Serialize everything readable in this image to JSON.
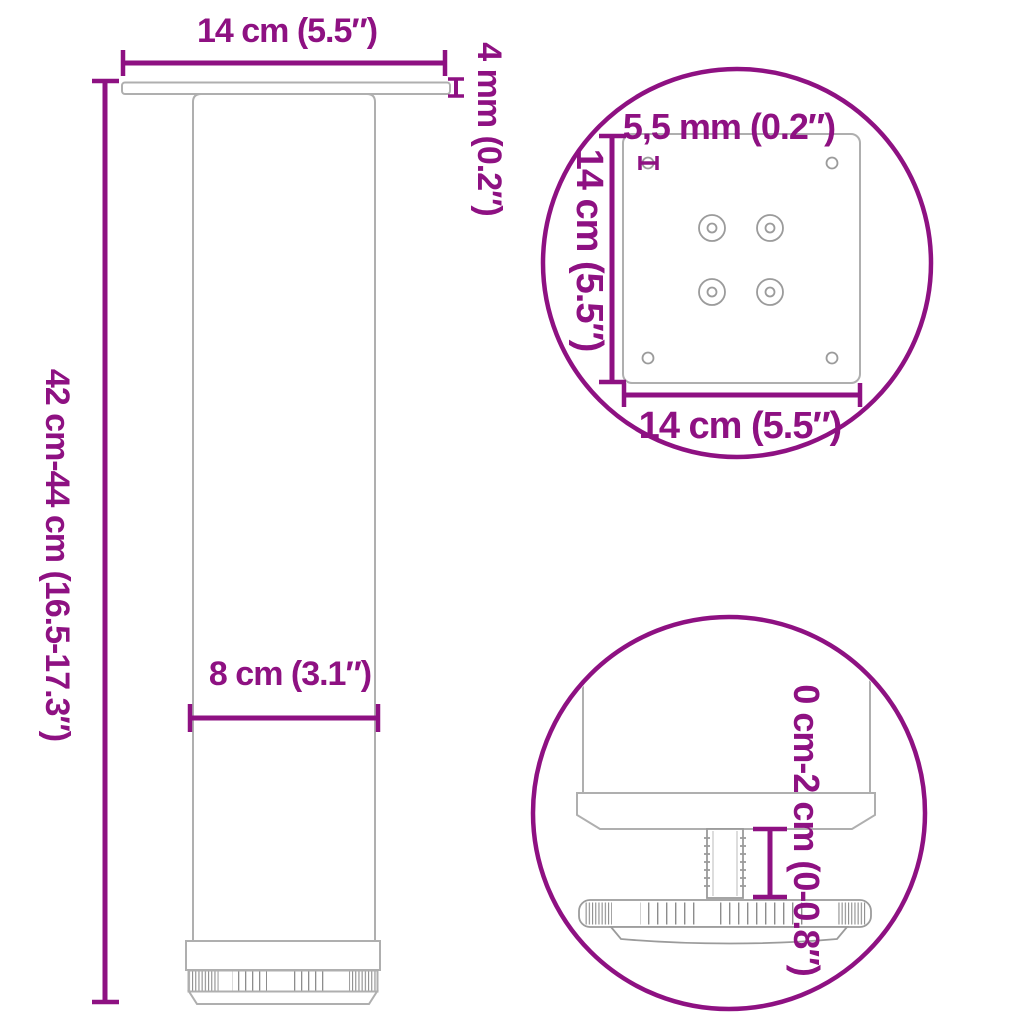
{
  "colors": {
    "accent": "#8E1182",
    "line": "#AFAFAF",
    "line_dark": "#8D8D8D",
    "hole": "#9B9B9B",
    "background": "#FFFFFF"
  },
  "main_view": {
    "plate_width_label": "14 cm (5.5″)",
    "plate_thickness_label": "4 mm (0.2″)",
    "leg_height_label": "42 cm-44 cm (16.5-17.3″)",
    "leg_diameter_label": "8 cm (3.1″)"
  },
  "plate_detail_view": {
    "hole_diameter_label": "5,5 mm (0.2″)",
    "plate_side_label": "14 cm (5.5″)",
    "plate_bottom_label": "14 cm (5.5″)"
  },
  "foot_detail_view": {
    "height_adjustment_label": "0 cm-2 cm (0-0.8″)"
  }
}
